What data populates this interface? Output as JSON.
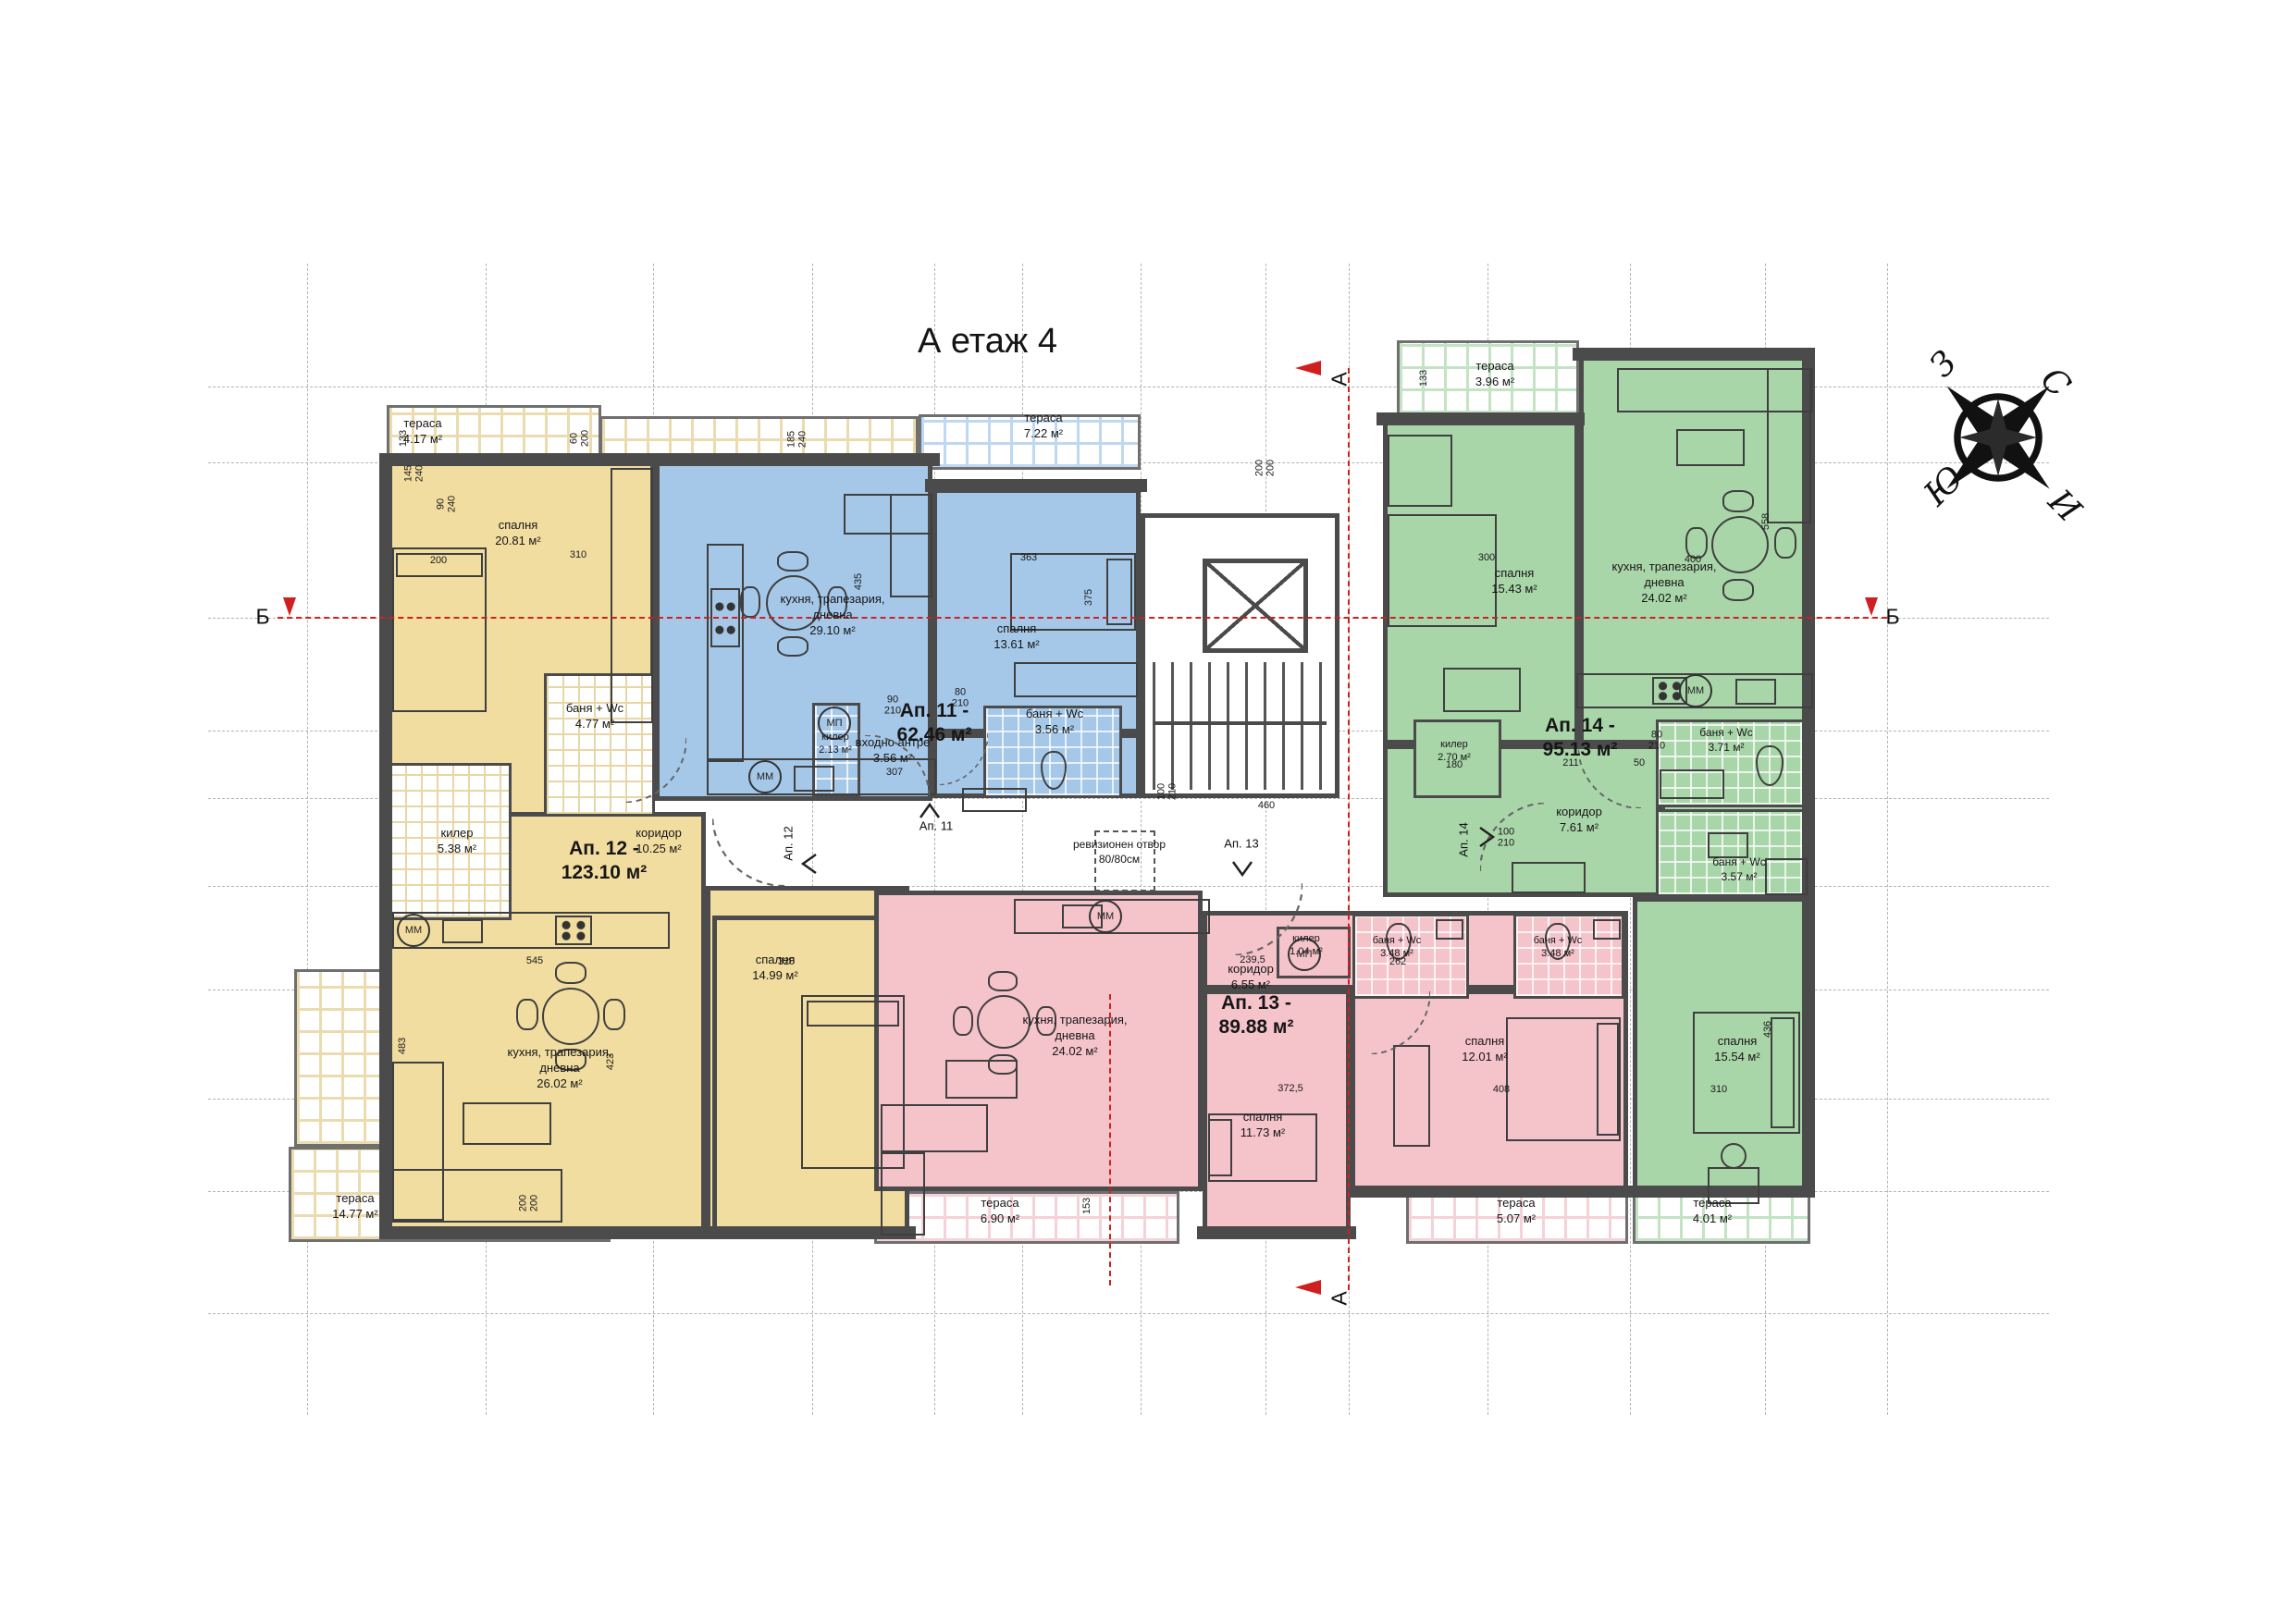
{
  "title": "А етаж 4",
  "compass": {
    "n": "С",
    "w": "З",
    "s": "Ю",
    "e": "И"
  },
  "sections": {
    "a": "А",
    "b": "Б"
  },
  "colors": {
    "ap11": "#A5C8E9",
    "ap12": "#F2DDA0",
    "ap13": "#F5C3CA",
    "ap14": "#A9D6A9",
    "wall": "#4B4B4B",
    "section_red": "#CF1F1F"
  },
  "corridor": {
    "rev1": "ревизионен отвор",
    "rev2": "80/80см"
  },
  "entrances": {
    "a11": "Ап. 11",
    "a12": "Ап. 12",
    "a13": "Ап. 13",
    "a14": "Ап. 14"
  },
  "symbols": {
    "mm": "ММ",
    "mp": "МП"
  },
  "ap11": {
    "t": "Ап. 11 -",
    "a": "62.46 м²",
    "kitchen": {
      "n1": "кухня, трапезария,",
      "n2": "дневна",
      "a": "29.10 м²"
    },
    "bedroom": {
      "n1": "спалня",
      "a": "13.61 м²"
    },
    "entry": {
      "n1": "входно антре",
      "a": "3.56 м²"
    },
    "storage": {
      "n1": "килер",
      "a": "2.13 м²"
    },
    "bath": {
      "n1": "баня + Wc",
      "a": "3.56 м²"
    },
    "terrace": {
      "n1": "тераса",
      "a": "7.22 м²"
    }
  },
  "ap12": {
    "t": "Ап. 12 -",
    "a": "123.10 м²",
    "bedroom1": {
      "n1": "спалня",
      "a": "20.81 м²"
    },
    "bath": {
      "n1": "баня + Wc",
      "a": "4.77 м²"
    },
    "storage": {
      "n1": "килер",
      "a": "5.38 м²"
    },
    "hall": {
      "n1": "коридор",
      "a": "10.25 м²"
    },
    "kitchen": {
      "n1": "кухня, трапезария,",
      "n2": "дневна",
      "a": "26.02 м²"
    },
    "bedroom2": {
      "n1": "спалня",
      "a": "14.99 м²"
    },
    "terrace1": {
      "n1": "тераса",
      "a": "4.17 м²"
    },
    "terrace2": {
      "n1": "тераса",
      "a": "14.77 м²"
    }
  },
  "ap13": {
    "t": "Ап. 13 -",
    "a": "89.88 м²",
    "kitchen": {
      "n1": "кухня, трапезария,",
      "n2": "дневна",
      "a": "24.02 м²"
    },
    "bedroom1": {
      "n1": "спалня",
      "a": "11.73 м²"
    },
    "bedroom2": {
      "n1": "спалня",
      "a": "12.01 м²"
    },
    "hall": {
      "n1": "коридор",
      "a": "6.55 м²"
    },
    "storage": {
      "n1": "килер",
      "a": "1.04 м²"
    },
    "bath1": {
      "n1": "баня + Wc",
      "a": "3.48 м²"
    },
    "bath2": {
      "n1": "баня + Wc",
      "a": "3.48 м²"
    },
    "terrace1": {
      "n1": "тераса",
      "a": "6.90 м²"
    },
    "terrace2": {
      "n1": "тераса",
      "a": "5.07 м²"
    }
  },
  "ap14": {
    "t": "Ап. 14 -",
    "a": "95.13 м²",
    "kitchen": {
      "n1": "кухня, трапезария,",
      "n2": "дневна",
      "a": "24.02 м²"
    },
    "bedroom1": {
      "n1": "спалня",
      "a": "15.43 м²"
    },
    "bedroom2": {
      "n1": "спалня",
      "a": "15.54 м²"
    },
    "hall": {
      "n1": "коридор",
      "a": "7.61 м²"
    },
    "storage": {
      "n1": "килер",
      "a": "2.70 м²"
    },
    "bath1": {
      "n1": "баня + Wc",
      "a": "3.71 м²"
    },
    "bath2": {
      "n1": "баня + Wc",
      "a": "3.57 м²"
    },
    "terrace1": {
      "n1": "тераса",
      "a": "3.96 м²"
    },
    "terrace2": {
      "n1": "тераса",
      "a": "4.01 м²"
    }
  },
  "dims": [
    {
      "t": "310"
    },
    {
      "t": "200"
    },
    {
      "t": "90\n240"
    },
    {
      "t": "133"
    },
    {
      "t": "145\n240"
    },
    {
      "t": "60\n200"
    },
    {
      "t": "185\n240"
    },
    {
      "t": "363"
    },
    {
      "t": "435"
    },
    {
      "t": "375"
    },
    {
      "t": "545"
    },
    {
      "t": "423"
    },
    {
      "t": "483"
    },
    {
      "t": "320"
    },
    {
      "t": "307"
    },
    {
      "t": "239,5"
    },
    {
      "t": "262"
    },
    {
      "t": "372,5"
    },
    {
      "t": "408"
    },
    {
      "t": "310"
    },
    {
      "t": "436"
    },
    {
      "t": "211"
    },
    {
      "t": "50"
    },
    {
      "t": "180"
    },
    {
      "t": "460"
    },
    {
      "t": "300"
    },
    {
      "t": "400"
    },
    {
      "t": "558"
    },
    {
      "t": "153"
    },
    {
      "t": "133"
    },
    {
      "t": "90\n210"
    },
    {
      "t": "80\n210"
    },
    {
      "t": "100\n210"
    },
    {
      "t": "80\n210"
    },
    {
      "t": "200\n200"
    },
    {
      "t": "100\n210"
    },
    {
      "t": "200\n200"
    }
  ]
}
